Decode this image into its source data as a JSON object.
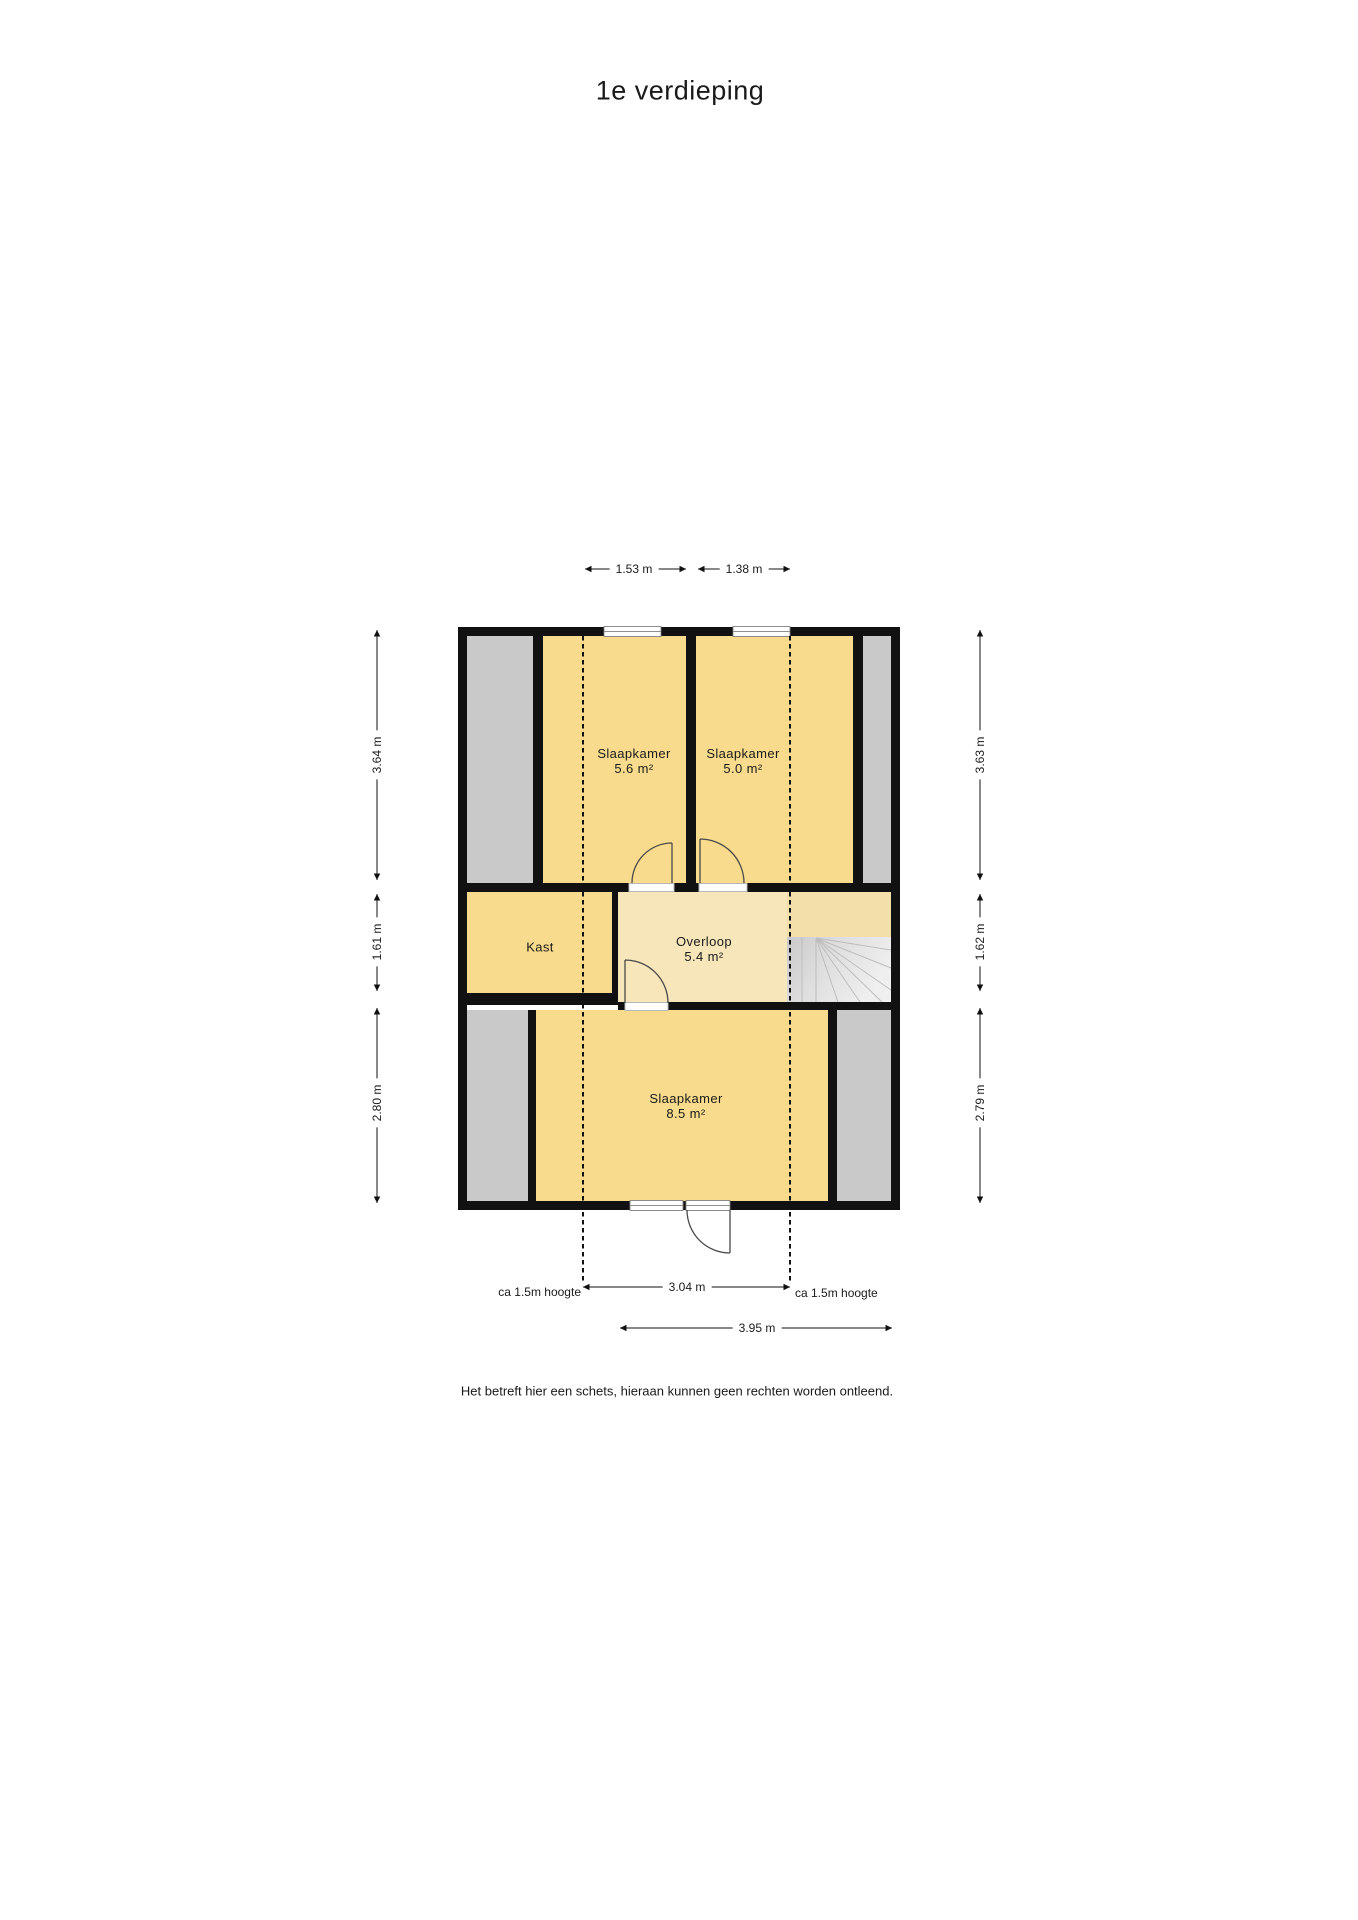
{
  "title": "1e verdieping",
  "disclaimer": "Het betreft hier een schets, hieraan kunnen geen rechten worden ontleend.",
  "rooms": {
    "bedroom_top_left": {
      "name": "Slaapkamer",
      "area": "5.6 m²"
    },
    "bedroom_top_right": {
      "name": "Slaapkamer",
      "area": "5.0 m²"
    },
    "closet": {
      "name": "Kast"
    },
    "landing": {
      "name": "Overloop",
      "area": "5.4 m²"
    },
    "bedroom_bottom": {
      "name": "Slaapkamer",
      "area": "8.5 m²"
    }
  },
  "dimensions": {
    "top": [
      {
        "label": "1.53 m"
      },
      {
        "label": "1.38 m"
      }
    ],
    "left": [
      {
        "label": "3.64 m"
      },
      {
        "label": "1.61 m"
      },
      {
        "label": "2.80 m"
      }
    ],
    "right": [
      {
        "label": "3.63 m"
      },
      {
        "label": "1.62 m"
      },
      {
        "label": "2.79 m"
      }
    ],
    "bottom": [
      {
        "label": "3.04 m"
      },
      {
        "label": "3.95 m"
      }
    ],
    "height_notes": [
      {
        "label": "ca 1.5m hoogte"
      },
      {
        "label": "ca 1.5m hoogte"
      }
    ]
  },
  "colors": {
    "room_fill": "#F8DB8C",
    "landing_fill": "#F7E6BA",
    "landing_shade_fill": "#F2DFA9",
    "roof_space_fill": "#C9C9C9",
    "wall": "#111111"
  }
}
